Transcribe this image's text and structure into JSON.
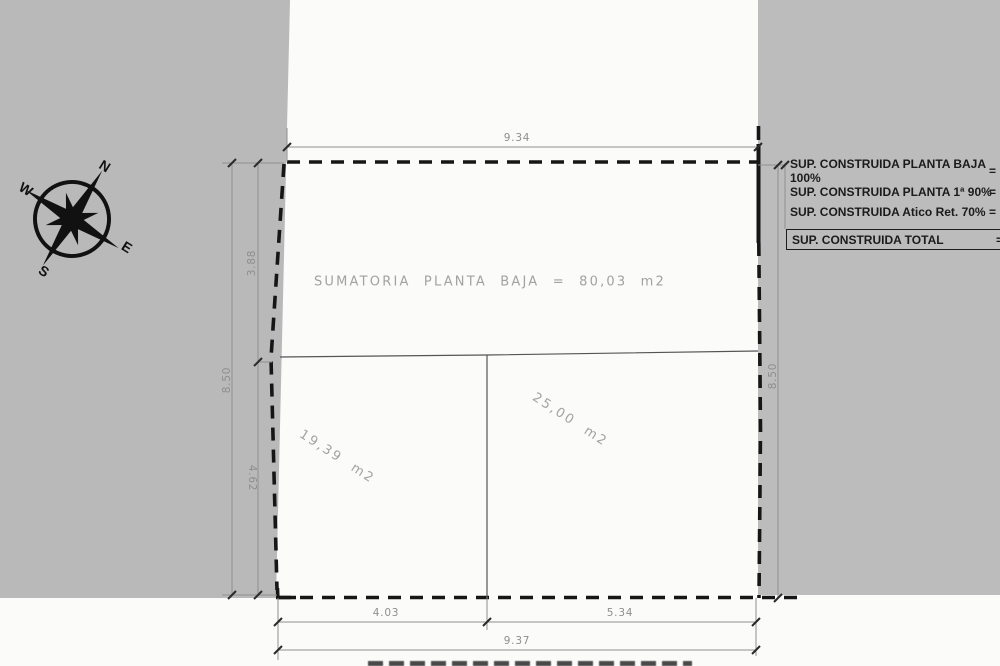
{
  "compass": {
    "north": "N",
    "south": "S",
    "east": "E",
    "west": "W"
  },
  "plan": {
    "summary_label": "SUMATORIA PLANTA BAJA = 80,03 m2",
    "room_left_area": "19,39 m2",
    "room_right_area": "25,00 m2",
    "dimensions": {
      "top": "9.34",
      "left_total": "8.50",
      "left_upper": "3.88",
      "left_lower": "4.62",
      "right_total": "8.50",
      "bottom_left": "4.03",
      "bottom_right": "5.34",
      "bottom_total": "9.37"
    }
  },
  "legend": {
    "rows": [
      {
        "label": "SUP. CONSTRUIDA PLANTA BAJA 100%",
        "eq": "="
      },
      {
        "label": "SUP. CONSTRUIDA PLANTA 1ª 90%",
        "eq": "="
      },
      {
        "label": "SUP. CONSTRUIDA Atico Ret.  70%",
        "eq": "="
      }
    ],
    "total": {
      "label": "SUP. CONSTRUIDA TOTAL",
      "eq": "="
    }
  },
  "colors": {
    "panel_gray": "#b9b9b9",
    "paper_white": "#fbfbfa",
    "boundary_black": "#161616",
    "dimension_gray": "#8e8e8e",
    "legend_text": "#1b1b1b"
  }
}
